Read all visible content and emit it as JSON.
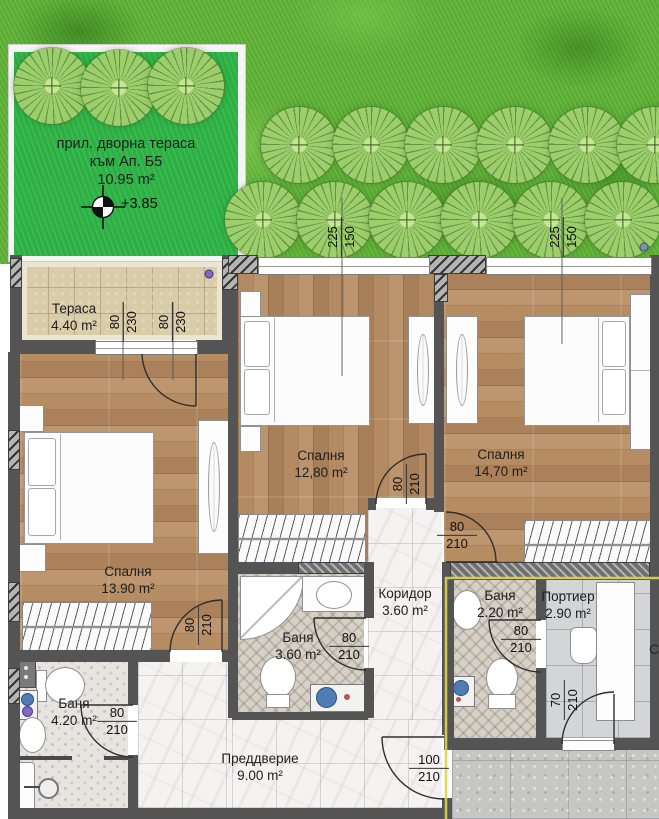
{
  "yard": {
    "label_line1": "прил. дворна тераса",
    "label_line2": "към Ап. Б5",
    "label_line3": "10.95 m²",
    "elevation": "+3.85"
  },
  "rooms": [
    {
      "id": "terrace",
      "name": "Тераса",
      "area": "4.40 m²"
    },
    {
      "id": "bedroom-left",
      "name": "Спалня",
      "area": "13.90 m²"
    },
    {
      "id": "bedroom-middle",
      "name": "Спалня",
      "area": "12,80 m²"
    },
    {
      "id": "bedroom-right",
      "name": "Спалня",
      "area": "14,70 m²"
    },
    {
      "id": "bath-middle",
      "name": "Баня",
      "area": "3.60 m²"
    },
    {
      "id": "corridor",
      "name": "Коридор",
      "area": "3.60 m²"
    },
    {
      "id": "bath-left",
      "name": "Баня",
      "area": "4.20 m²"
    },
    {
      "id": "bath-right",
      "name": "Баня",
      "area": "2.20 m²"
    },
    {
      "id": "porter",
      "name": "Портиер",
      "area": "2.90 m²"
    },
    {
      "id": "vestibule",
      "name": "Преддверие",
      "area": "9.00 m²"
    }
  ],
  "openings": [
    {
      "name": "terrace-door",
      "w": "80",
      "h": "230"
    },
    {
      "name": "terrace-window",
      "w": "80",
      "h": "230"
    },
    {
      "name": "bedroom-middle-window",
      "w": "225",
      "h": "150"
    },
    {
      "name": "bedroom-right-window",
      "w": "225",
      "h": "150"
    },
    {
      "name": "bedroom-left-door",
      "w": "80",
      "h": "210"
    },
    {
      "name": "bath-left-door",
      "w": "80",
      "h": "210"
    },
    {
      "name": "bath-middle-door",
      "w": "80",
      "h": "210"
    },
    {
      "name": "bedroom-middle-door",
      "w": "80",
      "h": "210"
    },
    {
      "name": "bedroom-right-door",
      "w": "80",
      "h": "210"
    },
    {
      "name": "bath-right-door",
      "w": "80",
      "h": "210"
    },
    {
      "name": "entry-door",
      "w": "100",
      "h": "210"
    },
    {
      "name": "porter-door",
      "w": "70",
      "h": "210"
    }
  ],
  "edge_label": "С",
  "colors": {
    "grass": "#5fb236",
    "terrace_green": "#2fb548",
    "wood": "#b38a61",
    "wall": "#545454",
    "boundary_yellow": "#ddd44e"
  }
}
